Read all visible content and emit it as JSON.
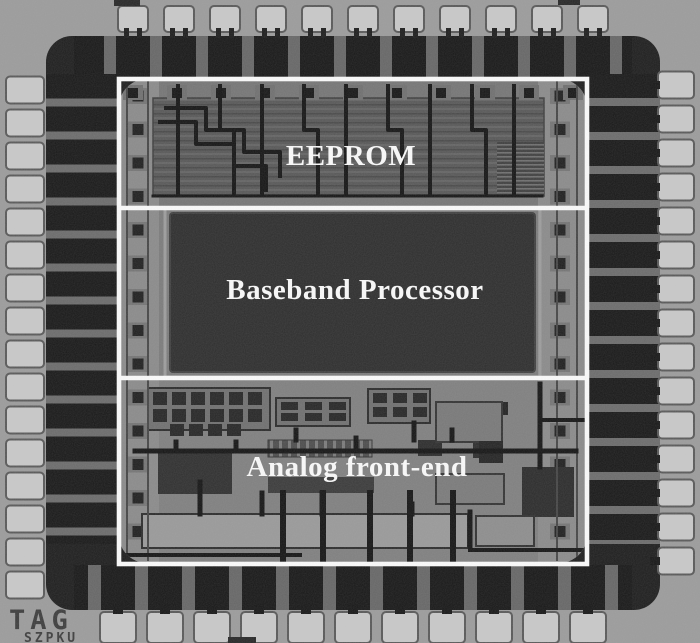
{
  "figure": {
    "type": "chip-die-micrograph",
    "description": "Grayscale microphotograph of an RFID tag chip die with bond-pad ring and three annotated functional blocks",
    "regions": [
      {
        "id": "eeprom",
        "label": "EEPROM"
      },
      {
        "id": "baseband",
        "label": "Baseband Processor"
      },
      {
        "id": "analog",
        "label": "Analog front-end"
      }
    ],
    "watermark": {
      "line1": "TAG",
      "line2": "SZPKU"
    },
    "colors": {
      "margin": "#9b9b9b",
      "seal_ring": "#1d1d1d",
      "ring_gap": "#6b6b6b",
      "die_surface": "#7d7d7d",
      "pad": "#c8c8c8",
      "pad_border": "#585858",
      "eeprom_block": "#565656",
      "baseband_core": "#2d2d2d",
      "inner_strip": "#8a8a8a",
      "trace": "#141414",
      "annotation_line": "#fbfbfb",
      "label_text": "#fafafa",
      "watermark_text": "#3c3c3c"
    }
  }
}
